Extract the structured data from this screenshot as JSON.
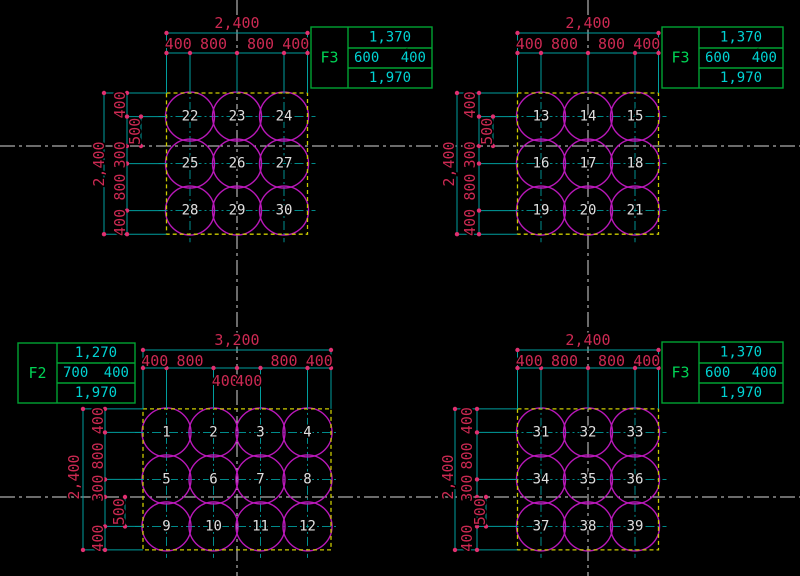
{
  "drawing_type": "pile-foundation-layout-plan",
  "colors": {
    "background": "#000000",
    "dimension_text": "#cc2952",
    "dimension_lines": "#009e9e",
    "pile_circles": "#b818b8",
    "pile_numbers": "#e0e0e0",
    "footing_outline_dashed": "#cbcb00",
    "table_border": "#00a332",
    "table_values": "#00d2d2",
    "grid_centerlines": "#d8d8d8"
  },
  "footings": [
    {
      "position": "top-left",
      "label": "F3",
      "table": {
        "top": "1,370",
        "mid_left": "600",
        "mid_right": "400",
        "bottom": "1,970"
      },
      "dim_top_total": "2,400",
      "dim_top_chain": [
        "400",
        "800",
        "800",
        "400"
      ],
      "dim_top_mid_chain": [],
      "dim_left_total": "2,400",
      "dim_left_chain": [
        "400",
        "300",
        "800",
        "400"
      ],
      "dim_left_offset": "500",
      "piles": [
        "22",
        "23",
        "24",
        "25",
        "26",
        "27",
        "28",
        "29",
        "30"
      ]
    },
    {
      "position": "top-right",
      "label": "F3",
      "table": {
        "top": "1,370",
        "mid_left": "600",
        "mid_right": "400",
        "bottom": "1,970"
      },
      "dim_top_total": "2,400",
      "dim_top_chain": [
        "400",
        "800",
        "800",
        "400"
      ],
      "dim_top_mid_chain": [],
      "dim_left_total": "2,400",
      "dim_left_chain": [
        "400",
        "300",
        "800",
        "400"
      ],
      "dim_left_offset": "500",
      "piles": [
        "13",
        "14",
        "15",
        "16",
        "17",
        "18",
        "19",
        "20",
        "21"
      ]
    },
    {
      "position": "bottom-left",
      "label": "F2",
      "table": {
        "top": "1,270",
        "mid_left": "700",
        "mid_right": "400",
        "bottom": "1,970"
      },
      "dim_top_total": "3,200",
      "dim_top_chain": [
        "400",
        "800",
        "800",
        "400"
      ],
      "dim_top_mid_chain": [
        "400",
        "400"
      ],
      "dim_left_total": "2,400",
      "dim_left_chain": [
        "400",
        "800",
        "300",
        "400"
      ],
      "dim_left_offset": "500",
      "piles": [
        "1",
        "2",
        "3",
        "4",
        "5",
        "6",
        "7",
        "8",
        "9",
        "10",
        "11",
        "12"
      ]
    },
    {
      "position": "bottom-right",
      "label": "F3",
      "table": {
        "top": "1,370",
        "mid_left": "600",
        "mid_right": "400",
        "bottom": "1,970"
      },
      "dim_top_total": "2,400",
      "dim_top_chain": [
        "400",
        "800",
        "800",
        "400"
      ],
      "dim_top_mid_chain": [],
      "dim_left_total": "2,400",
      "dim_left_chain": [
        "400",
        "800",
        "300",
        "400"
      ],
      "dim_left_offset": "500",
      "piles": [
        "31",
        "32",
        "33",
        "34",
        "35",
        "36",
        "37",
        "38",
        "39"
      ]
    }
  ]
}
